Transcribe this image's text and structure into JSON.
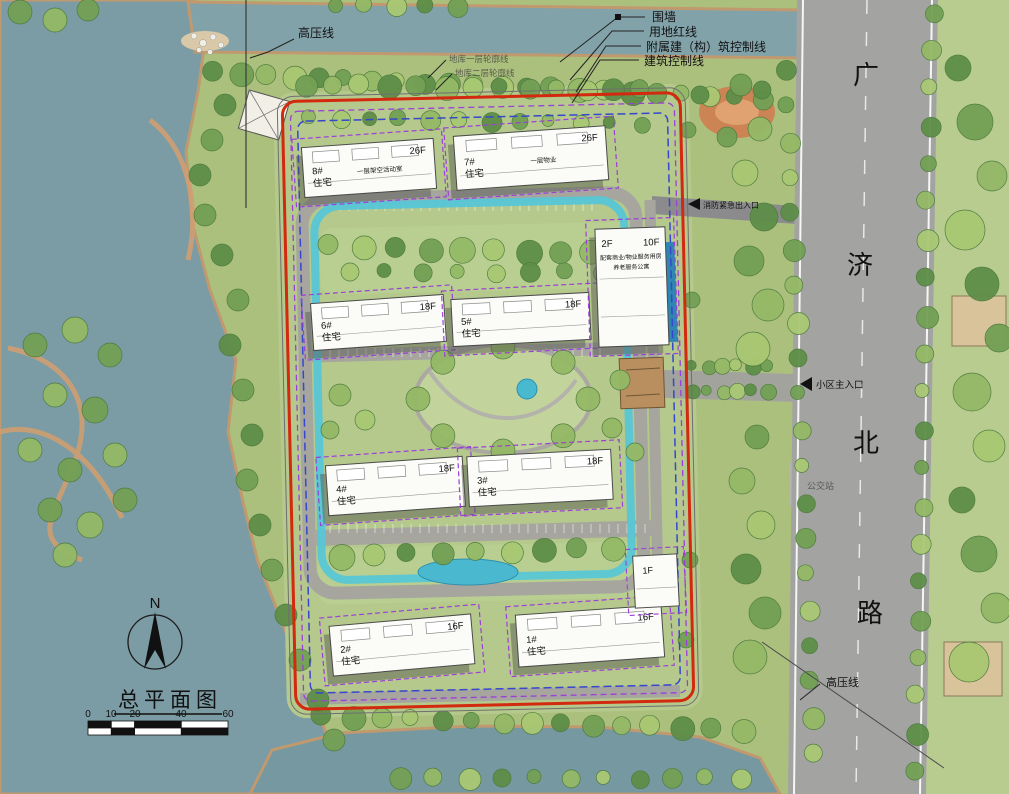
{
  "title_block": {
    "north_label": "N",
    "title": "总平面图",
    "scale_labels": [
      "0",
      "10",
      "20",
      "40",
      "60"
    ]
  },
  "road": {
    "name": "广济北路",
    "chars": [
      "广",
      "济",
      "北",
      "路"
    ]
  },
  "callouts": {
    "wall": "围墙",
    "red_line": "用地红线",
    "aux_control_line": "附属建（构）筑控制线",
    "building_control_line": "建筑控制线",
    "hv_top": "高压线",
    "hv_bottom": "高压线",
    "basement_l1": "地库一层轮廓线",
    "basement_l2": "地库二层轮廓线",
    "fire_entrance": "消防紧急出入口",
    "main_entrance": "小区主入口",
    "bus_stop": "公交站"
  },
  "buildings": [
    {
      "id": "8#",
      "use": "住宅",
      "floors": "26F",
      "note": "一层架空活动室",
      "x": 303,
      "y": 143,
      "w": 132,
      "h": 50,
      "rot": -4
    },
    {
      "id": "7#",
      "use": "住宅",
      "floors": "26F",
      "note": "一层物业",
      "x": 455,
      "y": 131,
      "w": 152,
      "h": 54,
      "rot": -4
    },
    {
      "id": "6#",
      "use": "住宅",
      "floors": "18F",
      "note": "",
      "x": 312,
      "y": 299,
      "w": 133,
      "h": 47,
      "rot": -4
    },
    {
      "id": "5#",
      "use": "住宅",
      "floors": "18F",
      "note": "",
      "x": 452,
      "y": 296,
      "w": 138,
      "h": 47,
      "rot": -3
    },
    {
      "id": "4#",
      "use": "住宅",
      "floors": "18F",
      "note": "",
      "x": 327,
      "y": 461,
      "w": 137,
      "h": 50,
      "rot": -4
    },
    {
      "id": "3#",
      "use": "住宅",
      "floors": "18F",
      "note": "",
      "x": 468,
      "y": 453,
      "w": 144,
      "h": 50,
      "rot": -3
    },
    {
      "id": "2#",
      "use": "住宅",
      "floors": "16F",
      "note": "",
      "x": 331,
      "y": 620,
      "w": 142,
      "h": 50,
      "rot": -5
    },
    {
      "id": "1#",
      "use": "住宅",
      "floors": "16F",
      "note": "",
      "x": 517,
      "y": 610,
      "w": 146,
      "h": 52,
      "rot": -4
    }
  ],
  "special": {
    "tower10f": {
      "left": "2F",
      "right": "10F",
      "line1": "配套商业/物业服务用房",
      "line2": "养老服务公寓"
    },
    "gatehouse1f": {
      "label": "1F"
    }
  },
  "colors": {
    "water": "#7b9ca4",
    "park_green": "#acc07e",
    "road_gray": "#a3a3a1",
    "red_boundary": "#d2290f",
    "blue_control": "#3647cc",
    "purple_control": "#9b3fd8",
    "cyan_loop": "#57c6d6",
    "building_fill": "#fbfbf8",
    "shadow": "#52524e",
    "tree_palette": [
      "#5e8e48",
      "#73a055",
      "#94b966",
      "#a9c873"
    ]
  }
}
